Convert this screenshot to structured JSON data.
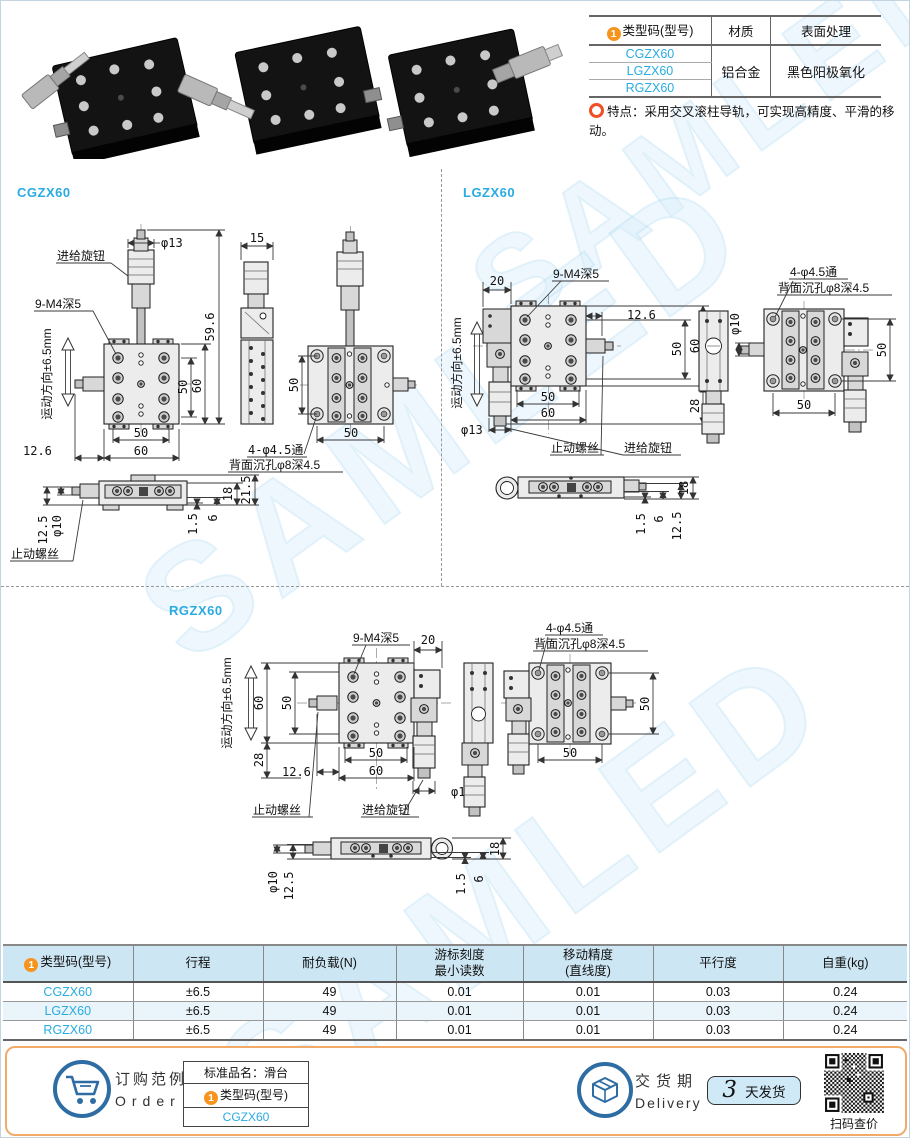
{
  "page": {
    "watermark": "SAMLED",
    "badge": "1"
  },
  "colors": {
    "accent_cyan": "#29abe2",
    "badge_orange": "#f7941d",
    "feature_ring": "#f04e23",
    "spec_header_blue": "#cde6f4",
    "spec_row_alt": "#e9f4fb",
    "footer_border_orange": "#f2aa6b",
    "icon_blue": "#2d6da3",
    "delivery_box_bg": "#cfe9f7"
  },
  "top_table": {
    "col_model": "类型码(型号)",
    "col_material": "材质",
    "col_surface": "表面处理",
    "models": [
      "CGZX60",
      "LGZX60",
      "RGZX60"
    ],
    "material": "铝合金",
    "surface": "黑色阳极氧化"
  },
  "feature": {
    "label": "特点：",
    "text": "采用交叉滚柱导轨，可实现高精度、平滑的移动。"
  },
  "drawings": {
    "cg": {
      "title": "CGZX60",
      "feed_knob": "进给旋钮",
      "stop_screw": "止动螺丝",
      "thread_note": "9-M4深5",
      "motion_note": "运动方向±6.5mm",
      "dia13": "φ13",
      "dia10": "φ10",
      "dim15": "15",
      "dim596": "59.6",
      "dim50v": "50",
      "dim60v": "60",
      "dim50b": "50",
      "dim60b": "60",
      "dim126": "12.6",
      "hole_line1": "4-φ4.5通",
      "hole_line2": "背面沉孔φ8深4.5",
      "dim50rv": "50",
      "dim50rb": "50",
      "dim125": "12.5",
      "dim15s": "1.5",
      "dim6": "6",
      "dim18": "18",
      "dim215": "21.5"
    },
    "lg": {
      "title": "LGZX60",
      "feed_knob": "进给旋钮",
      "stop_screw": "止动螺丝",
      "thread_note": "9-M4深5",
      "motion_note": "运动方向±6.5mm",
      "dim20": "20",
      "dim126": "12.6",
      "dim50v": "50",
      "dim60v": "60",
      "dim50b": "50",
      "dim60b": "60",
      "dim28": "28",
      "dia13": "φ13",
      "dia10": "φ10",
      "hole_line1": "4-φ4.5通",
      "hole_line2": "背面沉孔φ8深4.5",
      "dim50rv": "50",
      "dim50rb": "50",
      "dim18": "18",
      "dim15s": "1.5",
      "dim6": "6",
      "dim125": "12.5"
    },
    "rg": {
      "title": "RGZX60",
      "feed_knob": "进给旋钮",
      "stop_screw": "止动螺丝",
      "thread_note": "9-M4深5",
      "motion_note": "运动方向±6.5mm",
      "dim20": "20",
      "dim60v": "60",
      "dim50v": "50",
      "dim28": "28",
      "dim126": "12.6",
      "dim50b": "50",
      "dim60b": "60",
      "dia13": "φ13",
      "dia10": "φ10",
      "hole_line1": "4-φ4.5通",
      "hole_line2": "背面沉孔φ8深4.5",
      "dim50rv": "50",
      "dim50rb": "50",
      "dim125": "12.5",
      "dim15s": "1.5",
      "dim6": "6",
      "dim18": "18"
    }
  },
  "spec_table": {
    "headers": [
      "类型码(型号)",
      "行程",
      "耐负载(N)",
      "游标刻度\n最小读数",
      "移动精度\n(直线度)",
      "平行度",
      "自重(kg)"
    ],
    "rows": [
      {
        "model": "CGZX60",
        "travel": "±6.5",
        "load": "49",
        "vernier": "0.01",
        "accuracy": "0.01",
        "parallelism": "0.03",
        "weight": "0.24"
      },
      {
        "model": "LGZX60",
        "travel": "±6.5",
        "load": "49",
        "vernier": "0.01",
        "accuracy": "0.01",
        "parallelism": "0.03",
        "weight": "0.24"
      },
      {
        "model": "RGZX60",
        "travel": "±6.5",
        "load": "49",
        "vernier": "0.01",
        "accuracy": "0.01",
        "parallelism": "0.03",
        "weight": "0.24"
      }
    ]
  },
  "footer": {
    "order_zh": "订购范例",
    "order_en": "Order",
    "sample_title": "标准品名：滑台",
    "code_label": "类型码(型号)",
    "code_value": "CGZX60",
    "delivery_zh": "交货期",
    "delivery_en": "Delivery",
    "delivery_days": "3",
    "delivery_suffix": "天发货",
    "qr_caption": "扫码查价"
  }
}
